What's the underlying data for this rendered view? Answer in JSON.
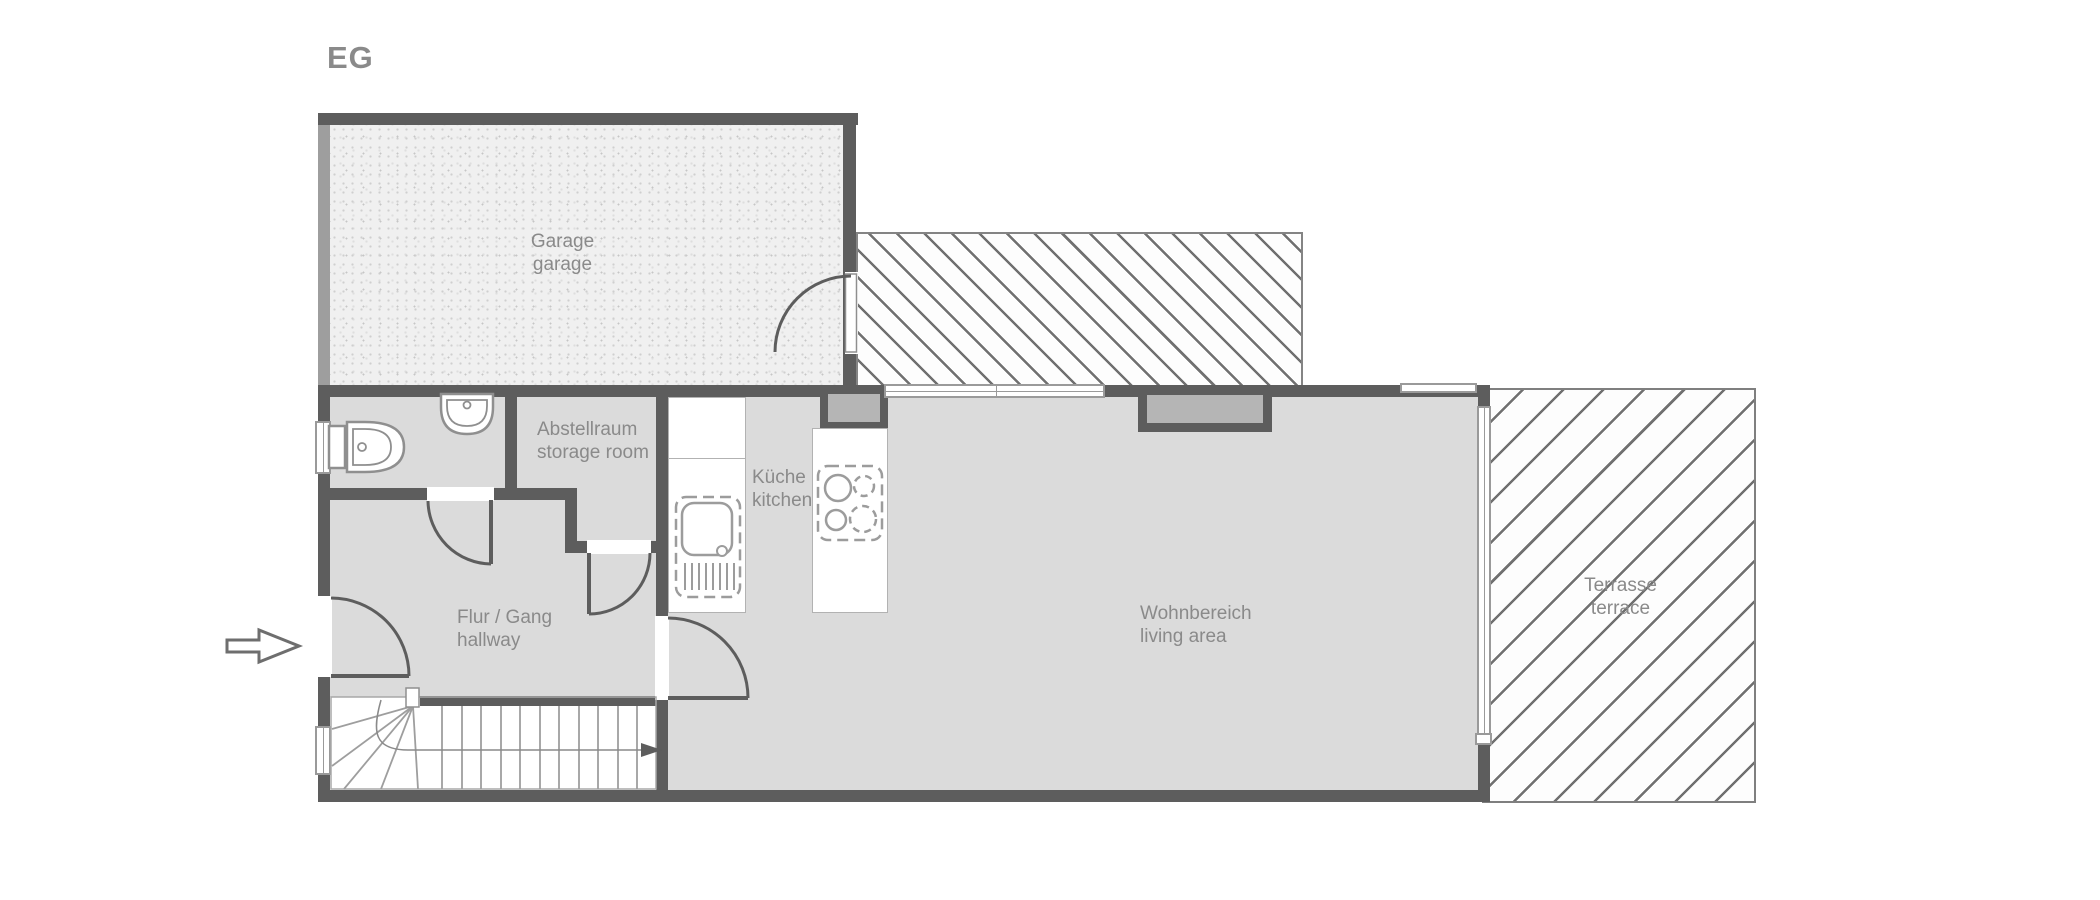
{
  "title": "EG",
  "rooms": {
    "garage": {
      "de": "Garage",
      "en": "garage"
    },
    "storage": {
      "de": "Abstellraum",
      "en": "storage room"
    },
    "kitchen": {
      "de": "Küche",
      "en": "kitchen"
    },
    "hallway": {
      "de": "Flur / Gang",
      "en": "hallway"
    },
    "living": {
      "de": "Wohnbereich",
      "en": "living area"
    },
    "terrace": {
      "de": "Terrasse",
      "en": "terrace"
    }
  },
  "icons": {
    "entrance_arrow": "entrance-direction-arrow",
    "stairs_arrow": "stairs-up-direction-arrow",
    "toilet": "toilet-fixture",
    "washbasin": "washbasin-fixture",
    "kitchen_sink": "kitchen-sink-fixture",
    "cooktop": "cooktop-fixture"
  },
  "colors": {
    "wall": "#5d5d5d",
    "wall_light": "#9e9e9e",
    "room_fill": "#dbdbdb",
    "chimney_fill": "#b5b5b5",
    "hatch_line": "#707070",
    "text": "#8a8a8a",
    "fixture_line": "#8f8f8f",
    "background": "#ffffff"
  }
}
